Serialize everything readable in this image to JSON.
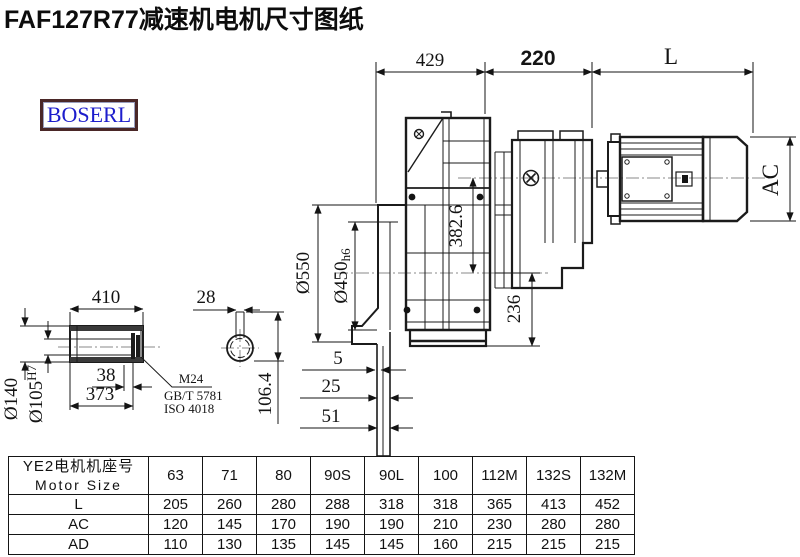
{
  "title": "FAF127R77减速机电机尺寸图纸",
  "logo": "BOSERL",
  "dims": {
    "w429": "429",
    "w220": "220",
    "wL": "L",
    "flange_od": "Ø550",
    "spigot_d": "Ø450",
    "spigot_tol": "h6",
    "axis_dist": "382.6",
    "foot_h": "236",
    "ac": "AC",
    "s5": "5",
    "s25": "25",
    "s51": "51",
    "shaft_len": "410",
    "shaft_od": "Ø140",
    "bore": "Ø105",
    "bore_tol": "H7",
    "recess": "38",
    "inner_len": "373",
    "key_w": "28",
    "key_h": "106.4",
    "bolt": "M24",
    "std1": "GB/T 5781",
    "std2": "ISO 4018"
  },
  "table": {
    "header_cn": "YE2电机机座号",
    "header_en": "Motor Size",
    "columns": [
      "63",
      "71",
      "80",
      "90S",
      "90L",
      "100",
      "112M",
      "132S",
      "132M"
    ],
    "rows": [
      {
        "label": "L",
        "values": [
          "205",
          "260",
          "280",
          "288",
          "318",
          "318",
          "365",
          "413",
          "452"
        ]
      },
      {
        "label": "AC",
        "values": [
          "120",
          "145",
          "170",
          "190",
          "190",
          "210",
          "230",
          "280",
          "280"
        ]
      },
      {
        "label": "AD",
        "values": [
          "110",
          "130",
          "135",
          "145",
          "145",
          "160",
          "215",
          "215",
          "215"
        ]
      }
    ]
  }
}
